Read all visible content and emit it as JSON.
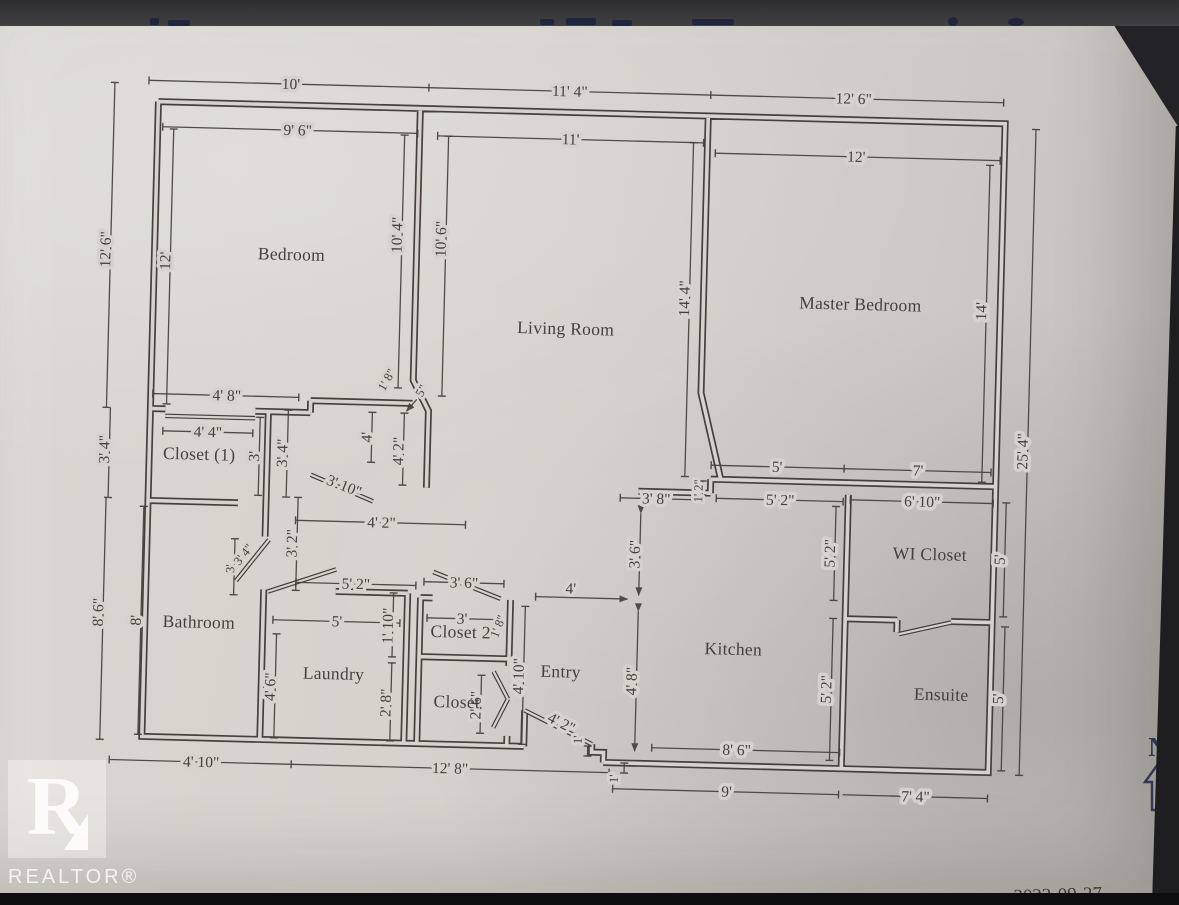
{
  "colors": {
    "paper": "#d6d2cc",
    "ink": "#45403a",
    "compass_navy": "#363c5c",
    "footer_navy": "#333850",
    "photo_bar": "#3a393b",
    "photo_black": "#0e0d10"
  },
  "rooms": {
    "bedroom": "Bedroom",
    "living": "Living Room",
    "master": "Master Bedroom",
    "closet1": "Closet  (1)",
    "bathroom": "Bathroom",
    "laundry": "Laundry",
    "closet2": "Closet 2",
    "closet": "Closet",
    "entry": "Entry",
    "kitchen": "Kitchen",
    "wicloset": "WI Closet",
    "ensuite": "Ensuite"
  },
  "dims": {
    "top_section_left": "10'",
    "top_section_mid": "11' 4\"",
    "top_section_right": "12' 6\"",
    "bedroom_width": "9' 6\"",
    "living_width": "11'",
    "master_width": "12'",
    "left_top": "12' 6\"",
    "left_mid": "3' 4\"",
    "left_bottom": "8' 6\"",
    "bedroom_height": "12'",
    "bathroom_height": "8'",
    "bedroom_right_height": "10' 4\"",
    "living_left_height": "10' 6\"",
    "living_right_height": "14' 4\"",
    "master_right_height": "14'",
    "right_total": "25' 4\"",
    "wi_closet_right": "5'",
    "ensuite_right": "5'",
    "closet1_opening": "4' 8\"",
    "closet1_door": "4' 4\"",
    "closet1_depth": "3'",
    "closet1_right": "3' 4\"",
    "bedroom_jog_diag": "1' 8\"",
    "bedroom_jog_offset": "5\"",
    "hall_top_left": "4'",
    "hall_top_right": "4' 2\"",
    "living_door_diag": "3' 10\"",
    "hall_width": "4' 2\"",
    "hall_height": "3' 2\"",
    "bath_door_diag": "3' 4\"",
    "bath_door_width": "3'",
    "laundry_door": "5' 2\"",
    "laundry_width": "5'",
    "laundry_height": "4' 6\"",
    "laundry_wall_upper": "1' 10\"",
    "laundry_wall_lower": "2' 8\"",
    "closet2_opening": "3' 6\"",
    "closet2_width": "3'",
    "closet2_side": "1' 8\"",
    "closet_door": "2' 6\"",
    "entry_width": "4'",
    "entry_height": "4' 10\"",
    "entry_door_diag": "4' 2\"",
    "entry_step_a": "1'",
    "entry_step_b": "1'",
    "kitchen_opening": "3' 8\"",
    "kitchen_jog": "1' 2\"",
    "kitchen_top": "5' 2\"",
    "wi_closet_width": "6' 10\"",
    "kitchen_left_upper": "3' 6\"",
    "kitchen_left_lower": "4' 8\"",
    "kitchen_right_upper": "5' 2\"",
    "kitchen_right_lower": "5' 2\"",
    "master_bottom_left": "5'",
    "master_bottom_right": "7'",
    "kitchen_bottom": "8' 6\"",
    "bottom_left": "4' 10\"",
    "bottom_mid": "12' 8\"",
    "bottom_kitchen": "9'",
    "bottom_right": "7' 4\""
  },
  "compass": {
    "letter": "N"
  },
  "watermark": {
    "letter": "R",
    "label": "REALTOR®"
  },
  "footer": {
    "page_number_fragment": "2",
    "page_text_fragment": "Pa",
    "date": "2022-09-27"
  }
}
